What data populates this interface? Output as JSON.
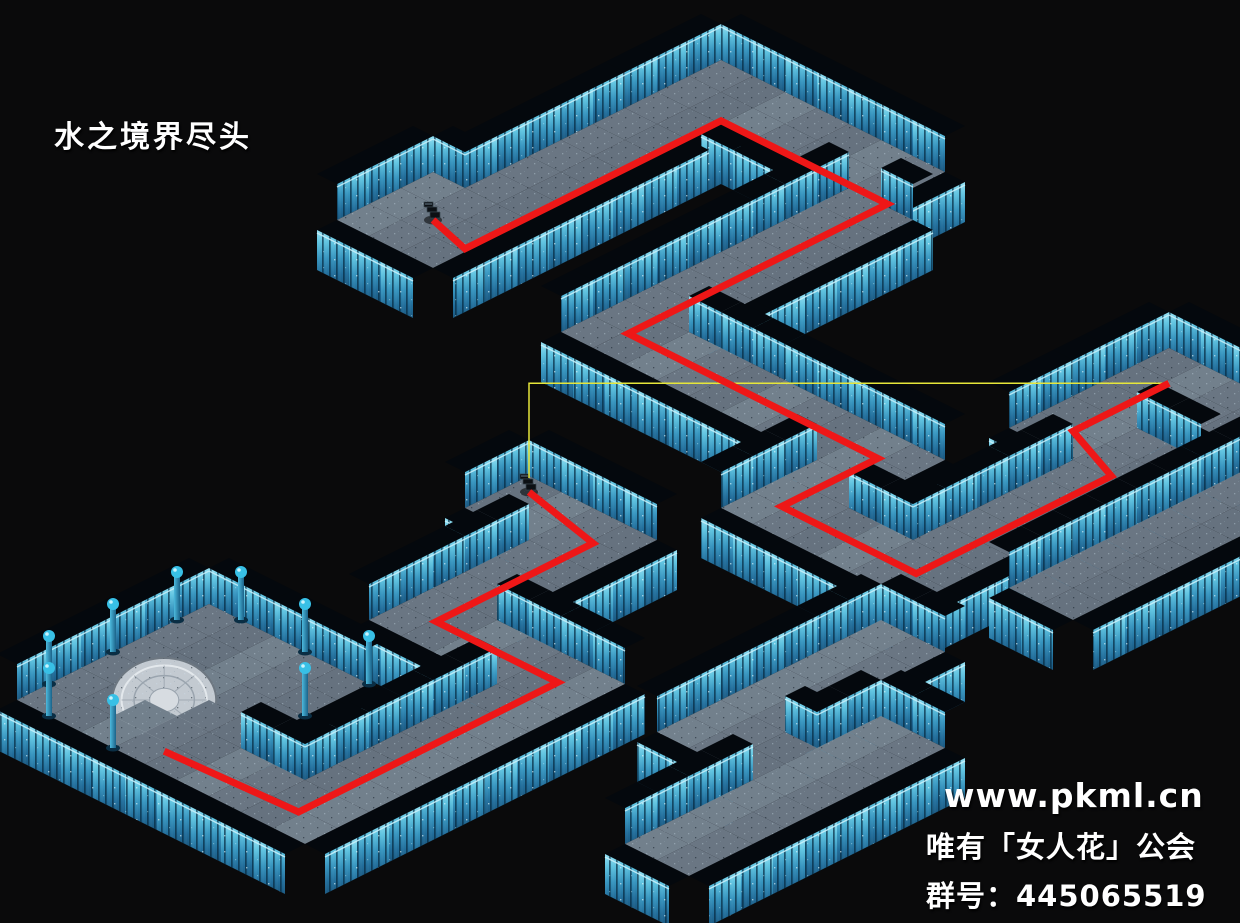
{
  "canvas": {
    "width": 1240,
    "height": 923,
    "background": "#0a0a0b"
  },
  "title": {
    "text": "水之境界尽头"
  },
  "watermark": {
    "site": "www.pkml.cn",
    "guild": "唯有「女人花」公会",
    "group": "群号：445065519"
  },
  "iso": {
    "origin_x": 561,
    "origin_y": 140,
    "half_w": 32,
    "half_h": 16,
    "back_wall_height": 36,
    "front_wall_height": 40,
    "cap_thickness_x": 20,
    "cap_thickness_y": 10
  },
  "colors": {
    "background": "#0a0a0b",
    "floor_shades": [
      "#6a7683",
      "#72808c",
      "#66727f"
    ],
    "wall_cap": "#04080d",
    "wall_top_rail": "#c9f1fb",
    "wall_face_top": "#93dff2",
    "wall_face_mid": "#3795bf",
    "wall_face_bottom": "#1a5880",
    "wall_plank": "rgba(6,40,62,0.7)",
    "route_red": "#ee1717",
    "link_yellow": "#e6e63a",
    "pillar_ball": "#38c0e6",
    "pillar_shaft_light": "#4db9dd",
    "pillar_shaft_dark": "#1b6389",
    "platform_light": "#c3cad1",
    "platform_mid": "#9aa4ae",
    "stairs_icon": "#0c1014"
  },
  "map": {
    "corridors": [
      {
        "id": "room-upper",
        "c0": -1,
        "c1": 1,
        "r0": 3,
        "r1": 5
      },
      {
        "id": "cor-a1",
        "c0": 0,
        "c1": 1,
        "r0": -4,
        "r1": 2
      },
      {
        "id": "cor-a2",
        "c0": 0,
        "c1": 6,
        "r0": -5,
        "r1": -4
      },
      {
        "id": "cor-a3",
        "c0": 6,
        "c1": 7,
        "r0": -3,
        "r1": 5
      },
      {
        "id": "cor-a4",
        "c0": 7,
        "c1": 15,
        "r0": 4,
        "r1": 5
      },
      {
        "id": "cor-a5",
        "c0": 14,
        "c1": 15,
        "r0": 5,
        "r1": 8
      },
      {
        "id": "cor-a6",
        "c0": 15,
        "c1": 19,
        "r0": 7,
        "r1": 8
      },
      {
        "id": "cor-a7",
        "c0": 18,
        "c1": 19,
        "r0": 1,
        "r1": 8
      },
      {
        "id": "cor-a8",
        "c0": 16,
        "c1": 19,
        "r0": 0,
        "r1": 1
      },
      {
        "id": "cor-a9",
        "c0": 16,
        "c1": 17,
        "r0": -3,
        "r1": 0
      },
      {
        "id": "cor-a10",
        "c0": 18,
        "c1": 21,
        "r0": -3,
        "r1": -2
      },
      {
        "id": "cor-a11",
        "c0": 21,
        "c1": 22,
        "r0": -2,
        "r1": 6
      },
      {
        "id": "cor-s3-top",
        "c0": 20,
        "c1": 21,
        "r0": 10,
        "r1": 14
      },
      {
        "id": "cor-s3-mid",
        "c0": 20,
        "c1": 23,
        "r0": 15,
        "r1": 16
      },
      {
        "id": "cor-s3-bar",
        "c0": 23,
        "c1": 24,
        "r0": 13,
        "r1": 20
      },
      {
        "id": "cor-b0",
        "c0": 10,
        "c1": 13,
        "r0": 11,
        "r1": 12
      },
      {
        "id": "cor-b1",
        "c0": 12,
        "c1": 13,
        "r0": 13,
        "r1": 17
      },
      {
        "id": "cor-b2",
        "c0": 12,
        "c1": 17,
        "r0": 16,
        "r1": 17
      },
      {
        "id": "cor-b3",
        "c0": 16,
        "c1": 17,
        "r0": 18,
        "r1": 25
      },
      {
        "id": "cor-b4",
        "c0": 13,
        "c1": 16,
        "r0": 24,
        "r1": 25
      },
      {
        "id": "room-lower",
        "c0": 9,
        "c1": 13,
        "r0": 20,
        "r1": 25
      }
    ]
  },
  "objects": {
    "stairs": [
      {
        "id": "stairs-upper",
        "icon": "spiral-stairs-icon",
        "c": 0,
        "r": 4
      },
      {
        "id": "stairs-lower",
        "icon": "spiral-stairs-icon",
        "c": 10,
        "r": 11
      }
    ],
    "magic_circle": {
      "c": 10.8,
      "r": 23.2,
      "rx": 52,
      "ry": 42
    },
    "pillars": [
      [
        9,
        21
      ],
      [
        9,
        23
      ],
      [
        9,
        25
      ],
      [
        10,
        20
      ],
      [
        12,
        20
      ],
      [
        14,
        20
      ],
      [
        14,
        22
      ],
      [
        10,
        26
      ],
      [
        12,
        26
      ]
    ]
  },
  "routes": {
    "red_walkthrough": {
      "part_a": [
        [
          0,
          4
        ],
        [
          1.4,
          4.4
        ],
        [
          1.4,
          -3.6
        ],
        [
          6.6,
          -3.6
        ],
        [
          6.6,
          4.5
        ],
        [
          14.4,
          4.5
        ],
        [
          14.4,
          7.5
        ],
        [
          18.6,
          7.5
        ],
        [
          18.6,
          1.4
        ],
        [
          16.6,
          0.6
        ],
        [
          16.6,
          -2.4
        ]
      ],
      "part_b": [
        [
          10,
          11
        ],
        [
          12.6,
          11.6
        ],
        [
          12.6,
          16.5
        ],
        [
          16.4,
          16.5
        ],
        [
          16.4,
          24.6
        ],
        [
          12.4,
          24.8
        ]
      ]
    },
    "yellow_link": {
      "from": "stairs-lower",
      "to": "red-part-a-end",
      "style": "axis-aligned"
    }
  }
}
